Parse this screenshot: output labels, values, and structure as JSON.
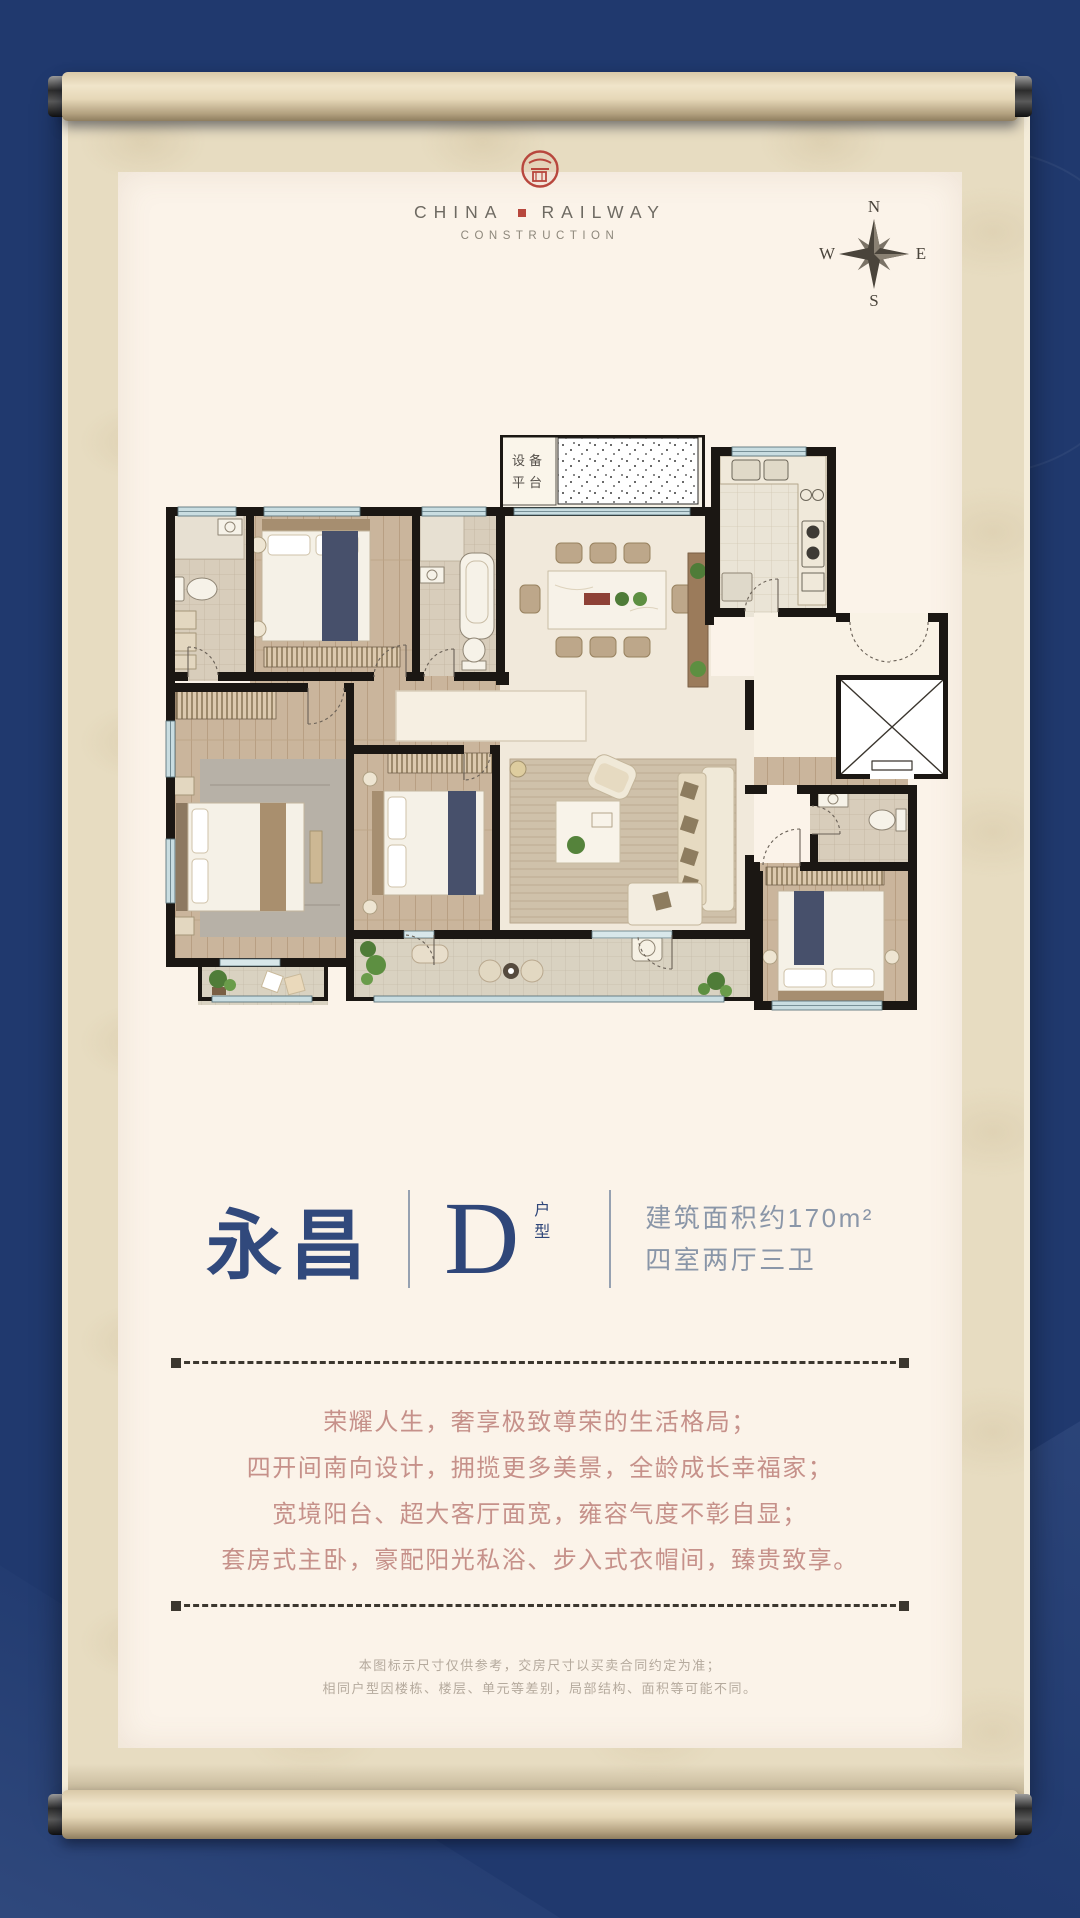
{
  "logo": {
    "line1_left": "CHINA",
    "line1_right": "RAILWAY",
    "line2": "CONSTRUCTION",
    "seal_color": "#b8473d"
  },
  "compass": {
    "n": "N",
    "e": "E",
    "s": "S",
    "w": "W"
  },
  "floorplan": {
    "platform_label_row1": "设备",
    "platform_label_row2": "平台"
  },
  "title": {
    "name": "永昌",
    "unit_letter": "D",
    "unit_suffix": "户型",
    "area_line": "建筑面积约170m²",
    "layout_line": "四室两厅三卫"
  },
  "marketing": {
    "lines": [
      "荣耀人生，奢享极致尊荣的生活格局；",
      "四开间南向设计，拥揽更多美景，全龄成长幸福家；",
      "宽境阳台、超大客厅面宽，雍容气度不彰自显；",
      "套房式主卧，豪配阳光私浴、步入式衣帽间，臻贵致享。"
    ]
  },
  "disclaimer": {
    "lines": [
      "本图标示尺寸仅供参考，交房尺寸以买卖合同约定为准；",
      "相同户型因楼栋、楼层、单元等差别，局部结构、面积等可能不同。"
    ]
  },
  "icons": {
    "crcc_seal": "red-circular-seal",
    "logo_separator": "red-square",
    "compass_rose": "eight-point-star"
  },
  "colors": {
    "background_navy": "#20396e",
    "scroll_beige": "#e7dcc1",
    "panel_cream": "#fbf3e9",
    "title_blue": "#31497c",
    "spec_gray_blue": "#8a96a8",
    "copy_rose": "#c6918a",
    "disclaimer_gray": "#b5aa9d",
    "seal_red": "#b8473d",
    "wall_black": "#1b1713",
    "window_blue": "#c9dde1"
  }
}
